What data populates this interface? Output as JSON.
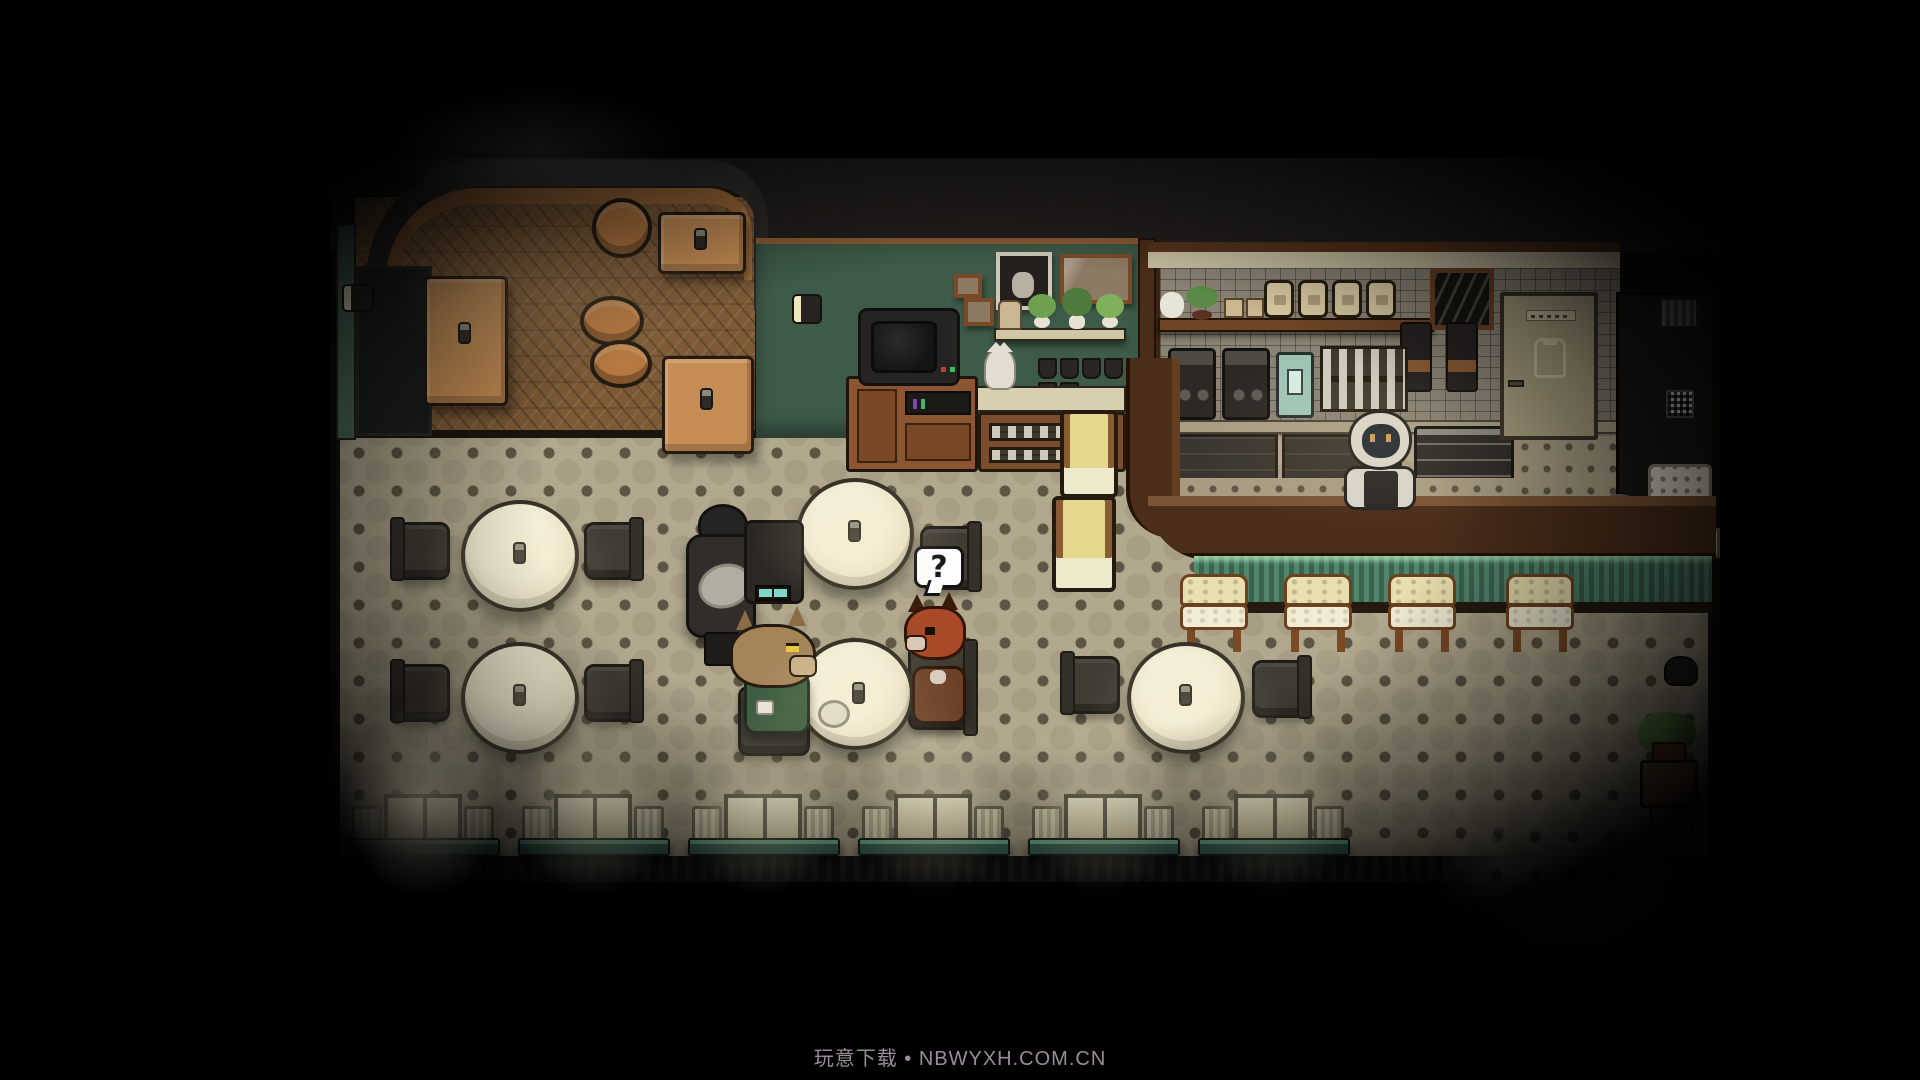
{
  "watermark": {
    "text": "玩意下载 • NBWYXH.COM.CN"
  },
  "speech_bubble": {
    "text": "?"
  },
  "scene": {
    "setting": "pixel-art cafe interior, top-down view",
    "characters": [
      "dark-coated figure standing with tray",
      "wolf customer in green sweater seated at table",
      "fox customer seated opposite with question bubble",
      "white-maned barista behind bar counter"
    ]
  },
  "palette": {
    "floor": "#b2a88e",
    "floor-dot": "#5f5545",
    "wood-floor": "#7d5a36",
    "wood-table": "#c68e55",
    "ochair": "#b5773f",
    "green-wall": "#3e5a48",
    "tile-wall": "#8a8274",
    "cream": "#d9caa2",
    "stool": "#e9dfae",
    "table-top": "#e9e0c4",
    "chair-dark": "#403b33",
    "window-glow": "#f8f0d2",
    "bench-green": "#3f6b5a",
    "bench-lit": "#79b891",
    "counter": "#4a2e1a",
    "counter-edge": "#7a5434",
    "door": "#a79c7e",
    "wolf-fur": "#a5845a",
    "wolf-sweater": "#3e5c40",
    "fox-fur": "#a84a28",
    "fox-body": "#6b4026",
    "figure-dark": "#302d2b",
    "tray": "#b2ada3",
    "barista-mane": "#d8d4c8",
    "barista-face": "#202830",
    "screen-teal": "#7fd8c8",
    "watermark-color": "#9b8c9b"
  }
}
